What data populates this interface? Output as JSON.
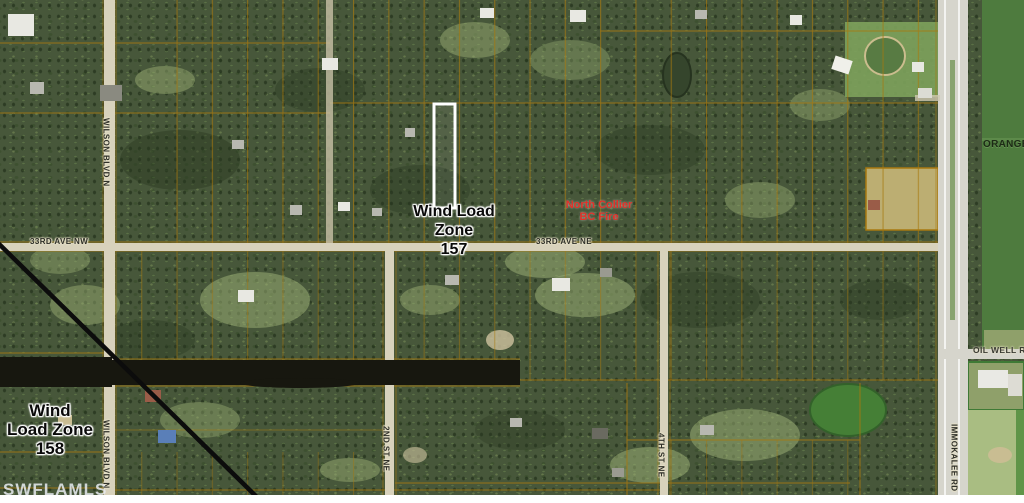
{
  "map": {
    "description": "Aerial parcel map with wind load zones and highlighted subject lot",
    "labels": {
      "wind_zone_157": {
        "line1": "Wind Load",
        "line2": "Zone",
        "line3": "157"
      },
      "wind_zone_158": {
        "line1": "Wind",
        "line2": "Load Zone",
        "line3": "158"
      },
      "fire_station": {
        "line1": "North Collier",
        "line2": "BC Fire"
      },
      "road_33rd_nw": "33RD AVE NW",
      "road_33rd_ne": "33RD AVE NE",
      "wilson_blvd_upper": "WILSON BLVD N",
      "wilson_blvd_lower": "WILSON BLVD N",
      "second_st": "2ND ST NE",
      "fourth_st": "4TH ST NE",
      "immokalee_rd": "IMMOKALEE RD",
      "oil_well_rd": "OIL WELL R",
      "orange_area": "ORANGE T",
      "watermark": "SWFLAMLS"
    },
    "colors": {
      "forest": "#47573a",
      "parcel_line": "#a8790f",
      "road": "#d8d2bc",
      "canal": "#17170f",
      "zone_boundary": "#0c0c0c",
      "subject_parcel_outline": "#ffffff",
      "fire_label": "#e0322a",
      "east_field": "#4e7b3e",
      "bottom_field": "#a9bd82"
    }
  }
}
